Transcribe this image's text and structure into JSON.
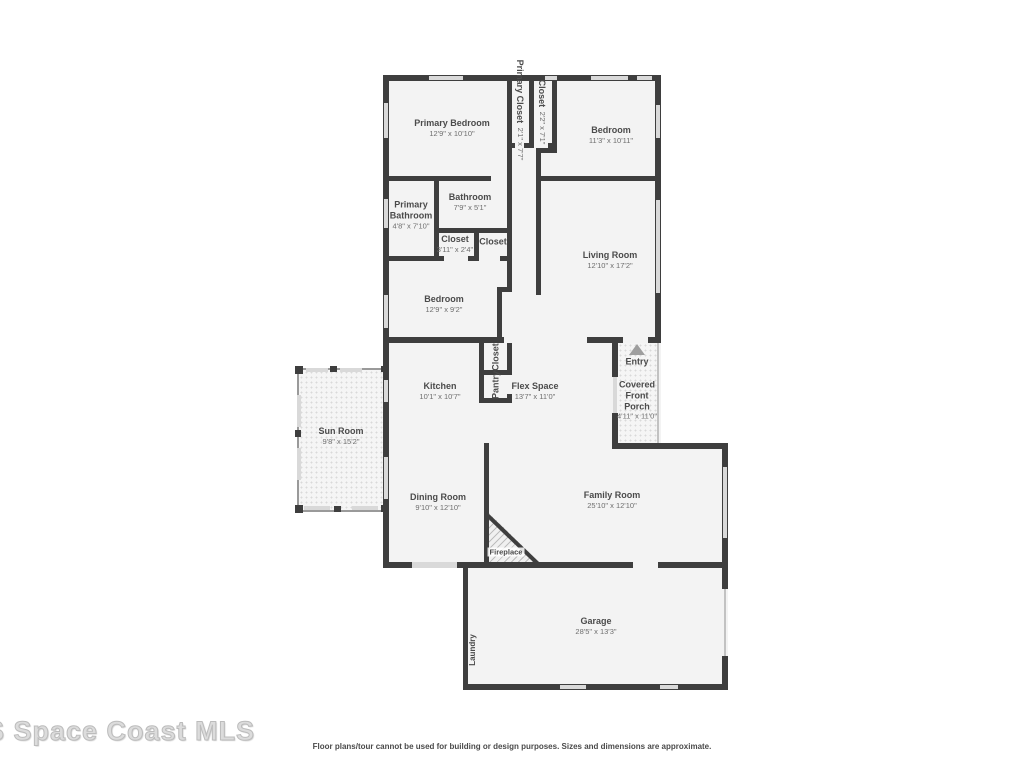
{
  "rooms": {
    "primary_bedroom": {
      "name": "Primary Bedroom",
      "dims": "12'9\" x 10'10\""
    },
    "primary_closet": {
      "name": "Primary Closet",
      "dims": "2'1\" x 7'7\""
    },
    "closet_top": {
      "name": "Closet",
      "dims": "2'2\" x 7'1\""
    },
    "bedroom_top": {
      "name": "Bedroom",
      "dims": "11'3\" x 10'11\""
    },
    "primary_bathroom": {
      "name": "Primary Bathroom",
      "dims": "4'8\" x 7'10\""
    },
    "bathroom": {
      "name": "Bathroom",
      "dims": "7'9\" x 5'1\""
    },
    "closet_hall": {
      "name": "Closet",
      "dims": "3'11\" x 2'4\""
    },
    "closet_hall2": {
      "name": "Closet",
      "dims": ""
    },
    "living_room": {
      "name": "Living Room",
      "dims": "12'10\" x 17'2\""
    },
    "bedroom_mid": {
      "name": "Bedroom",
      "dims": "12'9\" x 9'2\""
    },
    "kitchen": {
      "name": "Kitchen",
      "dims": "10'1\" x 10'7\""
    },
    "closet_kitchen": {
      "name": "Closet",
      "dims": ""
    },
    "pantry": {
      "name": "Pantry",
      "dims": ""
    },
    "flex_space": {
      "name": "Flex Space",
      "dims": "13'7\" x 11'0\""
    },
    "entry": {
      "name": "Entry",
      "dims": ""
    },
    "covered_front_porch": {
      "name": "Covered Front Porch",
      "dims": "4'11\" x 11'0\""
    },
    "sun_room": {
      "name": "Sun Room",
      "dims": "9'8\" x 15'2\""
    },
    "dining_room": {
      "name": "Dining Room",
      "dims": "9'10\" x 12'10\""
    },
    "family_room": {
      "name": "Family Room",
      "dims": "25'10\" x 12'10\""
    },
    "fireplace": {
      "name": "Fireplace",
      "dims": ""
    },
    "garage": {
      "name": "Garage",
      "dims": "28'5\" x 13'3\""
    },
    "laundry": {
      "name": "Laundry",
      "dims": ""
    }
  },
  "icons": {
    "entry_arrow": "triangle-up"
  },
  "colors": {
    "wall": "#3e3e3e",
    "window": "#d9d9d9",
    "floor": "#f3f3f3"
  },
  "watermark": "S Space Coast MLS",
  "disclaimer": "Floor plans/tour cannot be used for building or design purposes. Sizes and dimensions are approximate."
}
